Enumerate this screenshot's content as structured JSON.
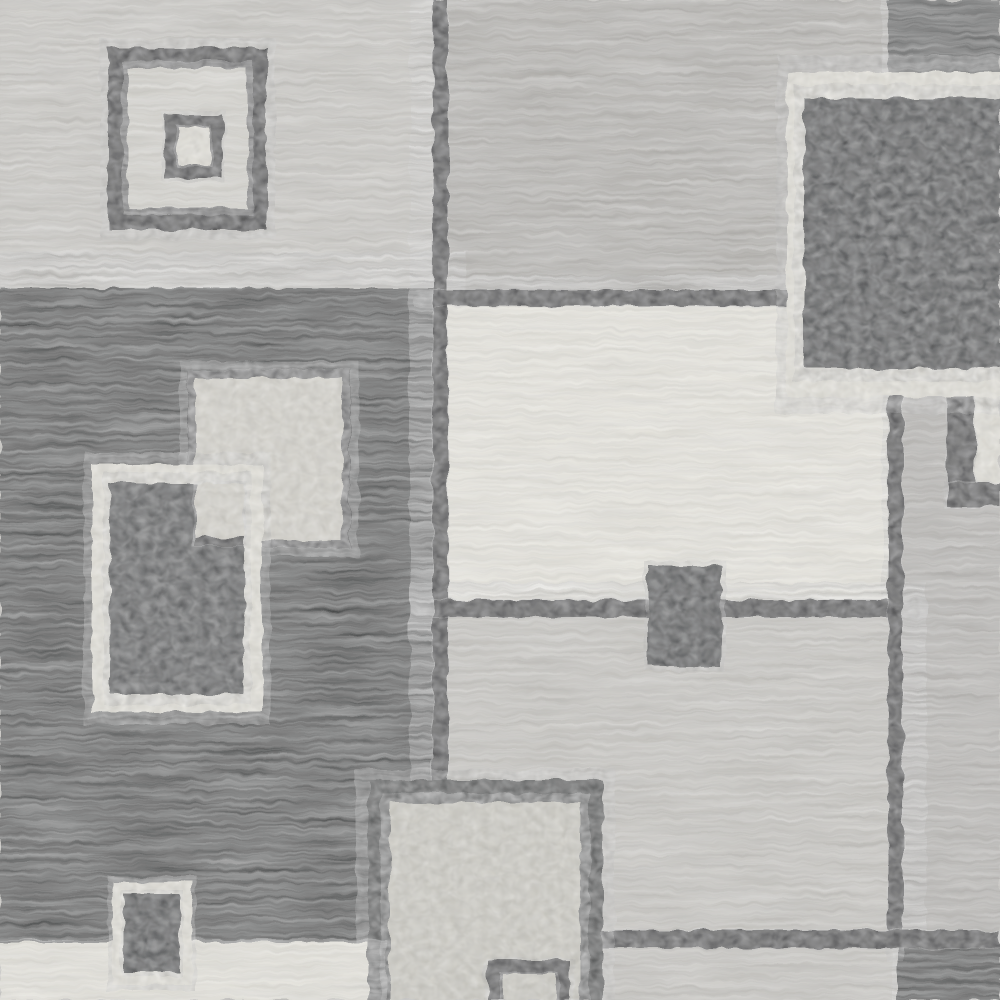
{
  "meta": {
    "type": "product-photo",
    "subject": "modern geometric area rug close-up",
    "pattern": "overlapping squares and rectangles grid",
    "orientation": "flat top-down crop, pattern bleeds off all edges"
  },
  "canvas": {
    "width": 1000,
    "height": 1000
  },
  "palette": {
    "lightGray": "#c9c7c2",
    "gray": "#b2b0ac",
    "gray2": "#b6b4b0",
    "gray3": "#c6c4bf",
    "darkGray": "#4b4d4e",
    "black": "#232526",
    "cream": "#eae8e0",
    "white": "#e7e5dd",
    "darkOutline": "#303334",
    "darkOutline2": "#3c3f40",
    "darkPebble": "#333637",
    "darkPebble2": "#404344",
    "lightFill": "#d8d6ce",
    "lightFill2": "#cfcdc5",
    "lighter": "#d6d4ce",
    "lighter2": "#e5e3db"
  },
  "textures": {
    "streak": "horizontal woven pile streaks",
    "pebble": "dense speckled cut pile"
  },
  "regions": [
    {
      "name": "panel-top-left",
      "x": 0,
      "y": 0,
      "w": 443,
      "h": 292,
      "color": "lightGray",
      "texture": "streak"
    },
    {
      "name": "panel-top-middle",
      "x": 433,
      "y": 0,
      "w": 467,
      "h": 300,
      "color": "gray",
      "texture": "streak"
    },
    {
      "name": "block-top-right-dark",
      "x": 888,
      "y": 0,
      "w": 112,
      "h": 86,
      "color": "darkGray",
      "texture": "streak"
    },
    {
      "name": "panel-left-black",
      "x": 0,
      "y": 288,
      "w": 443,
      "h": 712,
      "color": "black",
      "texture": "streak"
    },
    {
      "name": "panel-center-cream",
      "x": 433,
      "y": 292,
      "w": 470,
      "h": 326,
      "color": "cream",
      "texture": "streak"
    },
    {
      "name": "panel-right-gray",
      "x": 888,
      "y": 397,
      "w": 112,
      "h": 536,
      "color": "gray2",
      "texture": "streak"
    },
    {
      "name": "panel-bottom-middle-gray",
      "x": 433,
      "y": 600,
      "w": 470,
      "h": 348,
      "color": "gray3",
      "texture": "streak"
    },
    {
      "name": "strip-bottom-right-gray",
      "x": 577,
      "y": 933,
      "w": 423,
      "h": 67,
      "color": "gray3",
      "texture": "streak"
    },
    {
      "name": "block-bottom-right-black",
      "x": 898,
      "y": 946,
      "w": 102,
      "h": 54,
      "color": "black",
      "texture": "streak"
    },
    {
      "name": "gridline-vertical-left",
      "x": 433,
      "y": 0,
      "w": 15,
      "h": 790,
      "color": "darkOutline",
      "texture": "pebble"
    },
    {
      "name": "gridline-cream-top",
      "x": 433,
      "y": 290,
      "w": 357,
      "h": 16,
      "color": "darkOutline",
      "texture": "pebble"
    },
    {
      "name": "gridline-cream-bottom",
      "x": 433,
      "y": 600,
      "w": 470,
      "h": 17,
      "color": "darkOutline",
      "texture": "pebble"
    },
    {
      "name": "gridline-vertical-right",
      "x": 888,
      "y": 395,
      "w": 15,
      "h": 540,
      "color": "darkOutline",
      "texture": "pebble"
    },
    {
      "name": "gridline-horizontal-bottom",
      "x": 577,
      "y": 930,
      "w": 423,
      "h": 18,
      "color": "darkOutline",
      "texture": "pebble"
    },
    {
      "name": "right-edge-white-sliver",
      "x": 975,
      "y": 397,
      "w": 25,
      "h": 86,
      "color": "white",
      "texture": "pebble"
    },
    {
      "name": "right-edge-dark-corner-v",
      "x": 947,
      "y": 397,
      "w": 28,
      "h": 106,
      "color": "darkOutline",
      "texture": "pebble"
    },
    {
      "name": "right-edge-dark-corner-h",
      "x": 947,
      "y": 483,
      "w": 53,
      "h": 24,
      "color": "darkOutline",
      "texture": "pebble"
    },
    {
      "name": "tl-square-outline",
      "x": 108,
      "y": 48,
      "w": 159,
      "h": 182,
      "color": "darkOutline",
      "texture": "pebble"
    },
    {
      "name": "tl-square-interior",
      "x": 128,
      "y": 68,
      "w": 119,
      "h": 140,
      "color": "lighter",
      "texture": "streak"
    },
    {
      "name": "tl-inner-square-outline",
      "x": 165,
      "y": 114,
      "w": 58,
      "h": 64,
      "color": "darkOutline",
      "texture": "pebble"
    },
    {
      "name": "tl-inner-square-fill",
      "x": 178,
      "y": 127,
      "w": 32,
      "h": 38,
      "color": "lighter2",
      "texture": "pebble"
    },
    {
      "name": "tr-big-square-white-frame",
      "x": 787,
      "y": 72,
      "w": 213,
      "h": 325,
      "color": "white",
      "texture": "pebble"
    },
    {
      "name": "tr-big-square-interior",
      "x": 804,
      "y": 98,
      "w": 196,
      "h": 270,
      "color": "darkPebble",
      "texture": "pebble"
    },
    {
      "name": "mid-light-square-border",
      "x": 188,
      "y": 370,
      "w": 162,
      "h": 178,
      "color": "darkOutline",
      "texture": "pebble"
    },
    {
      "name": "mid-light-square-fill",
      "x": 196,
      "y": 378,
      "w": 146,
      "h": 162,
      "color": "lightFill",
      "texture": "pebble"
    },
    {
      "name": "white-rect-frame",
      "x": 92,
      "y": 465,
      "w": 170,
      "h": 247,
      "color": "white",
      "texture": "pebble"
    },
    {
      "name": "white-rect-interior",
      "x": 110,
      "y": 483,
      "w": 134,
      "h": 211,
      "color": "darkPebble2",
      "texture": "pebble"
    },
    {
      "name": "white-rect-overlap-light",
      "x": 196,
      "y": 483,
      "w": 48,
      "h": 54,
      "color": "lightFill",
      "texture": "pebble"
    },
    {
      "name": "white-rect-overlap-line",
      "x": 196,
      "y": 537,
      "w": 48,
      "h": 9,
      "color": "darkOutline",
      "texture": "pebble"
    },
    {
      "name": "center-small-dark-rect",
      "x": 648,
      "y": 566,
      "w": 74,
      "h": 100,
      "color": "darkPebble",
      "texture": "pebble"
    },
    {
      "name": "bottom-rect-border",
      "x": 368,
      "y": 780,
      "w": 235,
      "h": 220,
      "color": "darkOutline2",
      "texture": "pebble"
    },
    {
      "name": "bottom-rect-fill",
      "x": 390,
      "y": 803,
      "w": 190,
      "h": 197,
      "color": "lightFill2",
      "texture": "pebble"
    },
    {
      "name": "bottom-rect-inner-outline",
      "x": 488,
      "y": 960,
      "w": 82,
      "h": 40,
      "color": "darkOutline",
      "texture": "pebble"
    },
    {
      "name": "bottom-rect-inner-fill",
      "x": 502,
      "y": 974,
      "w": 54,
      "h": 26,
      "color": "lightFill2",
      "texture": "pebble"
    },
    {
      "name": "strip-bottom-left-white",
      "x": 0,
      "y": 942,
      "w": 368,
      "h": 58,
      "color": "white",
      "texture": "streak"
    },
    {
      "name": "bl-small-rect-frame",
      "x": 112,
      "y": 882,
      "w": 80,
      "h": 103,
      "color": "white",
      "texture": "pebble"
    },
    {
      "name": "bl-small-rect-interior",
      "x": 124,
      "y": 894,
      "w": 56,
      "h": 79,
      "color": "darkPebble",
      "texture": "pebble"
    }
  ]
}
